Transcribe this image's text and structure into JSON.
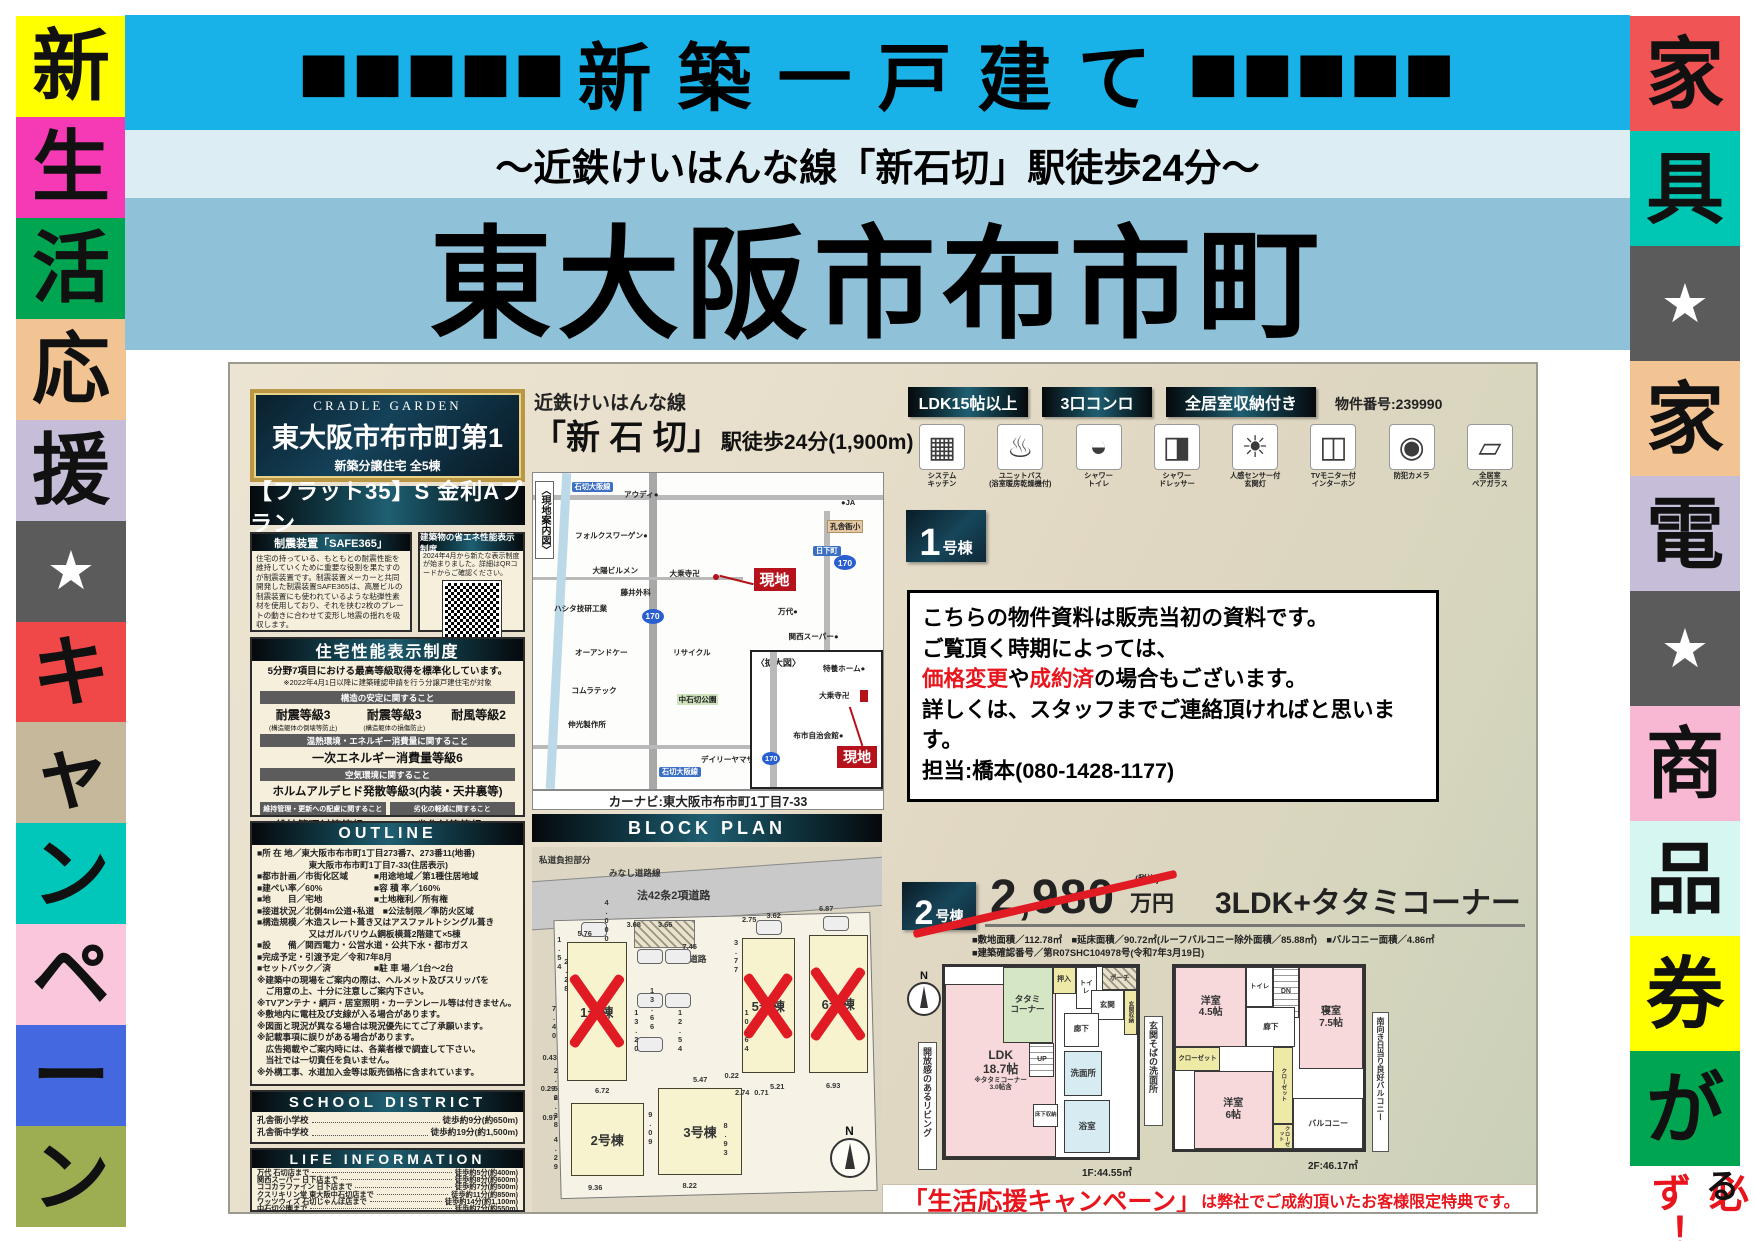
{
  "palette": {
    "cyan": "#18b2e8",
    "light_blue": "#dcedf4",
    "steel_blue": "#8fc2d8",
    "red_accent": "#e8151d",
    "genchi_red": "#b5121b",
    "gold": "#b99745",
    "dark_header": "#0d2430",
    "sold_x_red": "#e01b24"
  },
  "header": {
    "squares_left": "■■■■■",
    "title": "新築一戸建て",
    "squares_right": "■■■■■",
    "subtitle": "～近鉄けいはんな線「新石切」駅徒歩24分～",
    "main_title": "東大阪市布市町"
  },
  "left_strip": {
    "items": [
      {
        "ch": "新"
      },
      {
        "ch": "生"
      },
      {
        "ch": "活"
      },
      {
        "ch": "応"
      },
      {
        "ch": "援"
      },
      {
        "ch": "★"
      },
      {
        "ch": "キ"
      },
      {
        "ch": "ャ"
      },
      {
        "ch": "ン"
      },
      {
        "ch": "ペ"
      },
      {
        "ch": "ー"
      },
      {
        "ch": "ン"
      }
    ]
  },
  "right_strip": {
    "items": [
      {
        "ch": "家"
      },
      {
        "ch": "具"
      },
      {
        "ch": "★"
      },
      {
        "ch": "家"
      },
      {
        "ch": "電"
      },
      {
        "ch": "★"
      },
      {
        "ch": "商"
      },
      {
        "ch": "品"
      },
      {
        "ch": "券"
      },
      {
        "ch": "が"
      }
    ],
    "bottom_red": "必ず！",
    "bottom_black": "もらえる"
  },
  "flyer": {
    "left": {
      "plaque": {
        "brand": "CRADLE GARDEN",
        "name": "東大阪市布市町第1",
        "sub": "新築分譲住宅 全5棟"
      },
      "flat35": "【フラット35】S 金利Aプラン",
      "safe365": {
        "title": "制震装置「SAFE365」",
        "body": "住宅の持っている、もともとの耐震性能を維持していくために重要な役割を果たすのが制震装置です。制震装置メーカーと共同開発した制震装置SAFE365は、高層ビルの制震装置にも使われているような粘弾性素材を使用しており、それを挟む2枚のプレートの動きに合わせて変形し地震の揺れを吸収します。"
      },
      "energy": {
        "title": "建築物の省エネ性能表示制度",
        "body": "2024年4月から新たな表示制度が始まりました。詳細はQRコードからご確認ください。"
      },
      "performance": {
        "title": "住宅性能表示制度",
        "lead1": "5分野7項目における最高等級取得を標準化しています。",
        "lead2": "※2022年4月1日以降に建築確認申請を行う分譲戸建住宅が対象",
        "bar1": "構造の安定に関すること",
        "item1_main": "耐震等級3",
        "item1_sub": "(構造躯体の倒壊等防止)",
        "item2_main": "耐震等級3",
        "item2_sub": "(構造躯体の損傷防止)",
        "item3_main": "耐風等級2",
        "bar2": "温熱環境・エネルギー消費量に関すること",
        "item4_main": "一次エネルギー消費量等級6",
        "bar3": "空気環境に関すること",
        "item5_main": "ホルムアルデヒド発散等級3(内装・天井裏等)",
        "bar4a": "維持管理・更新への配慮に関すること",
        "item6_main": "維持管理対策等級3",
        "bar4b": "劣化の軽減に関すること",
        "item7_main": "劣化対策等級3"
      },
      "outline": {
        "title": "OUTLINE",
        "rows": [
          "■所 在 地／東大阪市布市町1丁目273番7、273番11(地番)",
          "　　　　　　東大阪市布市町1丁目7-33(住居表示)",
          "■都市計画／市街化区域　　　■用途地域／第1種住居地域",
          "■建ぺい率／60%　　　　　　■容 積 率／160%",
          "■地　　目／宅地　　　　　　■土地権利／所有権",
          "■接道状況／北側4m公道+私道　■公法制限／準防火区域",
          "■構造規模／木造スレート葺き又はアスファルトシングル葺き",
          "　　　　　　又はガルバリウム鋼板横葺2階建て×5棟",
          "■設　　備／関西電力・公営水道・公共下水・都市ガス",
          "■完成予定・引渡予定／令和7年8月",
          "■セットバック／済　　　　　■駐 車 場／1台～2台",
          "※建築中の現場をご案内の際は、ヘルメット及びスリッパを",
          "　ご用意の上、十分に注意しご案内下さい。",
          "※TVアンテナ・網戸・居室照明・カーテンレール等は付きません。",
          "※敷地内に電柱及び支線が入る場合があります。",
          "※図面と現況が異なる場合は現況優先にてご了承願います。",
          "※記載事項に誤りがある場合があります。",
          "　広告掲載やご案内時には、各業者様で調査して下さい。",
          "　当社では一切責任を負いません。",
          "※外構工事、水道加入金等は販売価格に含まれています。"
        ]
      },
      "school": {
        "title": "SCHOOL DISTRICT",
        "rows": [
          {
            "name": "孔舎衙小学校",
            "value": "徒歩約9分(約650m)"
          },
          {
            "name": "孔舎衙中学校",
            "value": "徒歩約19分(約1,500m)"
          }
        ]
      },
      "life": {
        "title": "LIFE INFORMATION",
        "rows": [
          {
            "name": "万代 石切店まで",
            "value": "徒歩約5分(約400m)"
          },
          {
            "name": "関西スーパー 日下店まで",
            "value": "徒歩約8分(約600m)"
          },
          {
            "name": "ココカラファイン 日下店まで",
            "value": "徒歩約7分(約500m)"
          },
          {
            "name": "クスリキリン堂 東大阪中石切店まで",
            "value": "徒歩約11分(約850m)"
          },
          {
            "name": "ワッツウィズ 石切じゃんぼ店まで",
            "value": "徒歩約14分(約1,100m)"
          },
          {
            "name": "中石切公園まで",
            "value": "徒歩約7分(約550m)"
          }
        ]
      }
    },
    "middle": {
      "rail_line": "近鉄けいはんな線",
      "station": "「新 石 切」",
      "station_suffix": "駅徒歩24分(1,900m)",
      "map": {
        "guide": "〈現地案内図〉",
        "labels": [
          "石切大阪線",
          "アウディ●",
          "●JA",
          "フォルクスワーゲン●",
          "孔舎衙小",
          "日下町",
          "大陽ビルメン",
          "大乗寺卍",
          "藤井外科",
          "ハシタ技研工業",
          "万代●",
          "関西スーパー●",
          "オーアンドケー",
          "リサイクル",
          "コムラテック",
          "中石切公園",
          "伸光製作所",
          "デイリーヤマザキ",
          "石切大阪線",
          "〈拡大図〉",
          "特養ホーム●",
          "大乗寺卍",
          "布市自治会館●",
          "現地",
          "現地",
          "170",
          "170",
          "170"
        ]
      },
      "navi": "カーナビ:東大阪市布市町1丁目7-33",
      "block_plan": {
        "title": "BLOCK PLAN",
        "labels": [
          "私道負担部分",
          "みなし道路線",
          "法42条2項道路",
          "協定道路"
        ],
        "lots": [
          {
            "name": "1号棟"
          },
          {
            "name": "2号棟"
          },
          {
            "name": "3号棟"
          },
          {
            "name": "5号棟"
          },
          {
            "name": "6号棟"
          }
        ],
        "compass": "N",
        "dims": [
          "5.76",
          "4.000",
          "3.68",
          "3.66",
          "7.45",
          "2.75",
          "3.62",
          "6.87",
          "3.77",
          "1.54",
          "2.28",
          "7.40",
          "13.66",
          "13.20",
          "12.54",
          "10.64",
          "0.43",
          "2.56",
          "0.29",
          "2.38",
          "0.97",
          "4.29",
          "9.36",
          "8.22",
          "6.72",
          "5.47",
          "0.22",
          "2.74",
          "0.71",
          "5.21",
          "6.93",
          "8.93",
          "9.09"
        ]
      }
    },
    "right": {
      "badges": [
        "LDK15帖以上",
        "3口コンロ",
        "全居室収納付き"
      ],
      "property_no": "物件番号:239990",
      "features": [
        {
          "label": "システム\nキッチン",
          "glyph": "▦"
        },
        {
          "label": "ユニットバス\n(浴室暖房乾燥機付)",
          "glyph": "♨"
        },
        {
          "label": "シャワー\nトイレ",
          "glyph": "◒"
        },
        {
          "label": "シャワー\nドレッサー",
          "glyph": "◨"
        },
        {
          "label": "人感センサー付\n玄関灯",
          "glyph": "☀"
        },
        {
          "label": "TVモニター付\nインターホン",
          "glyph": "◫"
        },
        {
          "label": "防犯カメラ",
          "glyph": "◉"
        },
        {
          "label": "全居室\nペアガラス",
          "glyph": "▱"
        }
      ],
      "unit1": {
        "num": "1",
        "suffix": "号棟"
      },
      "notice": {
        "l1": "こちらの物件資料は販売当初の資料です。",
        "l2": "ご覧頂く時期によっては、",
        "l3a": "価格変更",
        "l3b": "や",
        "l3c": "成約済",
        "l3d": "の場合もございます。",
        "l4": "詳しくは、スタッフまでご連絡頂ければと思います。",
        "l5": "担当:橋本(080-1428-1177)"
      },
      "unit2": {
        "num": "2",
        "suffix": "号棟",
        "price": "2,980",
        "tax_note": "(税込)",
        "price_unit": "万円",
        "plan": "3LDK+タタミコーナー",
        "spec1": "■敷地面積／112.78㎡　■延床面積／90.72㎡(ルーフバルコニー除外面積／85.88㎡)　■バルコニー面積／4.86㎡",
        "spec2": "■建築確認番号／第R07SHC104978号(令和7年3月19日)"
      },
      "fp1": {
        "ldk": "LDK\n18.7帖",
        "ldk_note": "※タタミコーナー\n3.0帖含",
        "tatami": "タタミ\nコーナー",
        "oshiire": "押入",
        "toilet": "トイレ",
        "porch": "ポーチ",
        "genkan": "玄関",
        "genkan_shuno": "玄関収納",
        "hall": "廊下",
        "up": "UP",
        "senmen": "洗面所",
        "bath": "浴室",
        "yukashita": "床下収納",
        "area": "1F:44.55㎡",
        "callout_left": "開放感のあるリビング",
        "callout_right": "玄関そばの洗面所"
      },
      "fp2": {
        "yoshitsu45": "洋室\n4.5帖",
        "toilet": "トイレ",
        "dn": "DN",
        "hall": "廊下",
        "shinshitsu": "寝室\n7.5帖",
        "closet1": "クローゼット",
        "yoshitsu6": "洋室\n6帖",
        "closet2": "クローゼット",
        "closet3": "クローゼット",
        "balcony": "バルコニー",
        "area": "2F:46.17㎡",
        "callout_right": "南向き日当り良好バルコニー"
      },
      "campaign": {
        "highlight": "「生活応援キャンペーン」",
        "rest": "は弊社でご成約頂いたお客様限定特典です。"
      }
    }
  }
}
